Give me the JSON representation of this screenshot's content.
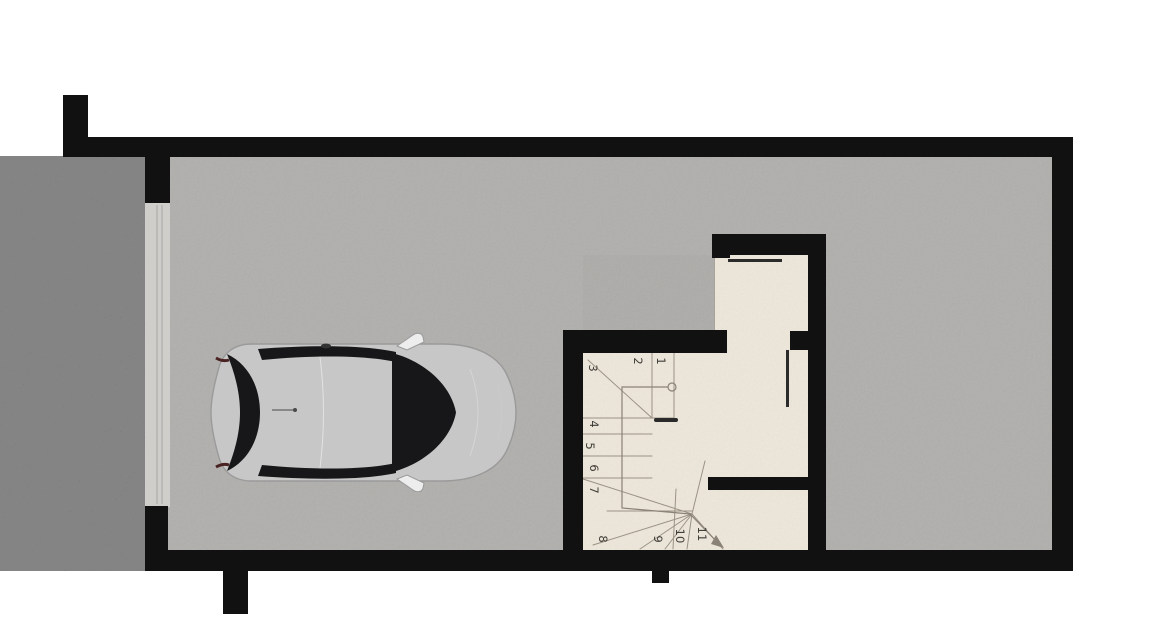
{
  "plan": {
    "type": "basement-garage-floor-plan",
    "rooms": [
      "driveway",
      "garage",
      "stair-hall"
    ],
    "car_present": true
  },
  "colors": {
    "background": "#ffffff",
    "wall": "#111111",
    "asphalt_base": "#3a3a3a",
    "asphalt_speckle": "#9a9a9a",
    "garage_floor": "#b7b6b4",
    "garage_door_panel": "#cfcecb",
    "garage_door_line": "#a8a7a4",
    "stair_floor": "#f1eade",
    "stair_line": "#9b9285",
    "walk_line": "#8a8276",
    "door_leaf": "#2b2b2b",
    "step_number": "#3f3d38",
    "car_window": "#17171a",
    "car_body_white": "#ffffff",
    "car_outline": "#9a9a9a",
    "tail_light": "#4a2222"
  },
  "stairs": {
    "steps": [
      "1",
      "2",
      "3",
      "4",
      "5",
      "6",
      "7",
      "8",
      "9",
      "10",
      "11"
    ]
  }
}
